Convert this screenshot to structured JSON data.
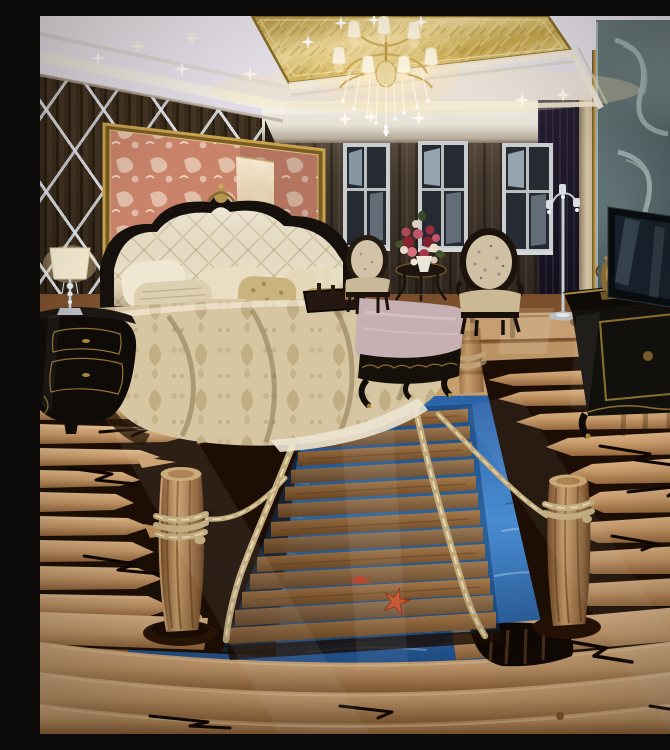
{
  "meta": {
    "title": "Luxury bedroom with 3D rope-bridge floor mural",
    "description": "Photograph of an ornate bedroom: gold coffered ceiling with a crystal chandelier and star-like recessed lights, dark wood wall with mirrored diamond lattice and a gold-framed coral damask panel behind a cream tufted bed, three windows with dark drapes, two classic armchairs with a flower bouquet on a side table, a black-and-gold TV cabinet with a brass samovar, and a glossy 3D floor mural of a wooden plank rope bridge crossing blue water between broken log shores with mooring posts, a starfish and cracks.",
    "width": 670,
    "height": 718
  },
  "palette": {
    "ceilingWhite": "#eeeaf1",
    "ceilingGold": "#d4b45c",
    "goldTrim": "#a8863c",
    "coveGlow": "#f9e6b0",
    "wallWood": "#35281a",
    "latticeSilver": "#dde4ea",
    "panelCoral": "#c9836b",
    "panelFrame": "#c9a24e",
    "backwallCream": "#eae6dc",
    "curtainBrown": "#3a3128",
    "windowFrame": "#c9cdcd",
    "windowDark": "#262b33",
    "skyPale": "#a9bac4",
    "headboardBlack": "#15100b",
    "tuftCream": "#e9dfc8",
    "duvetChampagne": "#d6c7a2",
    "pillowGold": "#c9b47e",
    "benchMauve": "#c6b0b2",
    "chairFabric": "#d0c1a4",
    "chairWood": "#1e150e",
    "nightstandBlack": "#0f0b08",
    "lampShade": "#f6ecd2",
    "rightCurtain": "#1a1524",
    "glassTeal": "#5d6e70",
    "glassSwirl": "#c2d2d0",
    "tvBlack": "#0b0e11",
    "tvSpine": "#b9c0c5",
    "samovarBrass": "#8a6b33",
    "floorAmber": "#9a6a3e",
    "logTan": "#d8ad7c",
    "logShadow": "#a87848",
    "plankBrown": "#8a6038",
    "waterBlue": "#2e6cb0",
    "waterDeep": "#1d4f8e",
    "rope": "#c0a97c",
    "postBark": "#b98c5c",
    "starfishRed": "#c4502a",
    "crackBlack": "#0d0602"
  },
  "scene": {
    "ceiling": {
      "elements": [
        "gold-coffer-panel",
        "crystal-chandelier",
        "recessed-star-lights",
        "white-cove-molding"
      ],
      "chandelier_shade_count": 7,
      "star_light_count": 14
    },
    "walls": {
      "left": "dark wood paneling with mirrored diamond lattice and gold-framed coral damask panel",
      "back": "three windows with dark brown sheer drapes above a cream cove band",
      "right": "etched teal glass scroll panel beside a near-black curtain and cream column"
    },
    "furniture": [
      "tufted-headboard-bed",
      "pillows",
      "damask-duvet",
      "candle-tray",
      "black-gold-nightstand",
      "crystal-table-lamp",
      "upholstered-bench",
      "armchair-left",
      "armchair-right",
      "round-side-table",
      "flower-bouquet",
      "silver-floor-lamp",
      "tv-cabinet",
      "brass-samovar",
      "flat-tv"
    ],
    "floor_mural": {
      "subject": "wooden plank rope bridge over blue water between broken log shores",
      "elements": [
        "glossy-log-floor",
        "log-shore-left",
        "log-shore-right",
        "bottom-logs",
        "water",
        "plank-bridge",
        "rope-railings",
        "mooring-post-left",
        "mooring-post-right",
        "distant-post",
        "starfish",
        "crab",
        "cracks",
        "broken-hole"
      ],
      "plank_count": 13,
      "post_count": 2
    }
  }
}
